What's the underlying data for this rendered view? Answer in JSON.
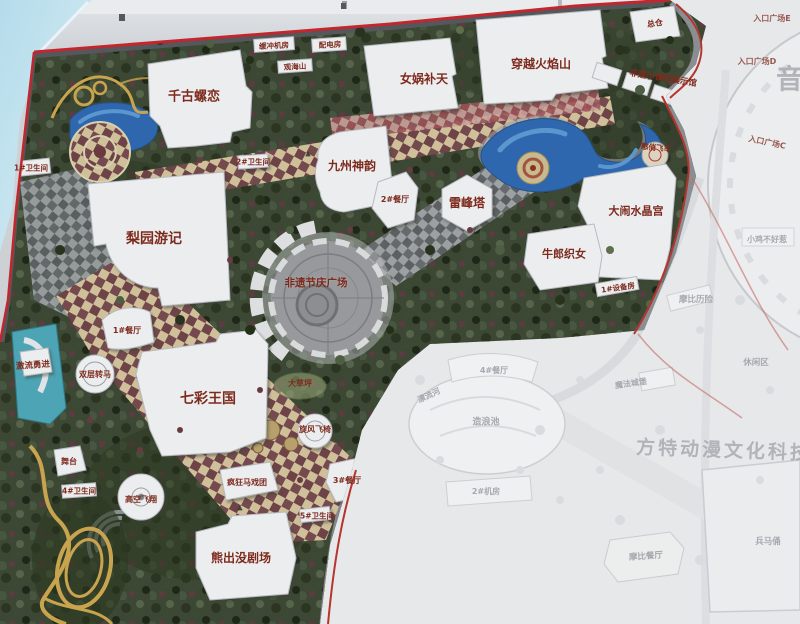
{
  "meta": {
    "description": "Photographed theme park master-plan map on a signboard"
  },
  "colors": {
    "label_red": "#7d2b1d",
    "faded_text": "#a2a6ab",
    "water_blue": "#2e67ad",
    "checker_maroon": "#754a4e",
    "checker_cream": "#cfc09a",
    "red_trim": "#c1272d",
    "sky_corner": "#b5dceb",
    "watermark_gray": "#a4a7ac"
  },
  "map": {
    "labels": [
      {
        "t": "千古螺恋",
        "x": 194,
        "y": 97,
        "s": 13,
        "c": "park"
      },
      {
        "t": "女娲补天",
        "x": 424,
        "y": 79,
        "s": 12,
        "c": "park"
      },
      {
        "t": "穿越火焰山",
        "x": 541,
        "y": 64,
        "s": 12,
        "c": "park"
      },
      {
        "t": "九州神韵",
        "x": 352,
        "y": 166,
        "s": 12,
        "c": "park"
      },
      {
        "t": "雷峰塔",
        "x": 467,
        "y": 203,
        "s": 12,
        "c": "park"
      },
      {
        "t": "大闹水晶宫",
        "x": 636,
        "y": 211,
        "s": 11,
        "c": "park"
      },
      {
        "t": "牛郎织女",
        "x": 564,
        "y": 254,
        "s": 11,
        "c": "park"
      },
      {
        "t": "梨园游记",
        "x": 154,
        "y": 239,
        "s": 14,
        "c": "park"
      },
      {
        "t": "七彩王国",
        "x": 208,
        "y": 399,
        "s": 14,
        "c": "park"
      },
      {
        "t": "熊出没剧场",
        "x": 241,
        "y": 558,
        "s": 12,
        "c": "park"
      },
      {
        "t": "非遗节庆广场",
        "x": 316,
        "y": 283,
        "s": 10.5,
        "c": "park"
      },
      {
        "t": "总仓",
        "x": 655,
        "y": 24,
        "s": 8,
        "c": "park-sm",
        "r": -8
      },
      {
        "t": "2#餐厅",
        "x": 395,
        "y": 200,
        "s": 8,
        "c": "park-sm"
      },
      {
        "t": "1#餐厅",
        "x": 127,
        "y": 331,
        "s": 8,
        "c": "park-sm"
      },
      {
        "t": "双层转马",
        "x": 95,
        "y": 375,
        "s": 8,
        "c": "park-sm"
      },
      {
        "t": "激流勇进",
        "x": 33,
        "y": 366,
        "s": 8.5,
        "c": "park-sm",
        "r": -4
      },
      {
        "t": "舞台",
        "x": 69,
        "y": 462,
        "s": 8,
        "c": "park-sm"
      },
      {
        "t": "高空飞翔",
        "x": 141,
        "y": 500,
        "s": 8,
        "c": "park-sm"
      },
      {
        "t": "4#卫生间",
        "x": 79,
        "y": 491,
        "s": 7.5,
        "c": "park-sm"
      },
      {
        "t": "疯狂马戏团",
        "x": 247,
        "y": 483,
        "s": 8,
        "c": "park-sm"
      },
      {
        "t": "旋风飞椅",
        "x": 315,
        "y": 430,
        "s": 8,
        "c": "park-sm"
      },
      {
        "t": "3#餐厅",
        "x": 347,
        "y": 481,
        "s": 8,
        "c": "park-sm"
      },
      {
        "t": "5#卫生间",
        "x": 317,
        "y": 516,
        "s": 7.5,
        "c": "park-sm"
      },
      {
        "t": "1#卫生间",
        "x": 31,
        "y": 168,
        "s": 7.5,
        "c": "park-sm"
      },
      {
        "t": "2#卫生间",
        "x": 253,
        "y": 162,
        "s": 7.5,
        "c": "park-sm"
      },
      {
        "t": "1#设备房",
        "x": 618,
        "y": 288,
        "s": 7.5,
        "c": "park-sm",
        "r": -8
      },
      {
        "t": "缓冲机房",
        "x": 274,
        "y": 46,
        "s": 7.5,
        "c": "park-sm",
        "r": -3
      },
      {
        "t": "配电房",
        "x": 330,
        "y": 45,
        "s": 7.5,
        "c": "park-sm",
        "r": -3
      },
      {
        "t": "观海山",
        "x": 295,
        "y": 67,
        "s": 7.5,
        "c": "park-sm",
        "r": -3
      },
      {
        "t": "憨俏飞车",
        "x": 656,
        "y": 148,
        "s": 7.5,
        "c": "park-sm",
        "r": 6
      },
      {
        "t": "大草坪",
        "x": 300,
        "y": 384,
        "s": 8,
        "c": "park-sm"
      },
      {
        "t": "非遗小镇和展示馆",
        "x": 663,
        "y": 79,
        "s": 8.5,
        "c": "park-sm",
        "r": 9
      },
      {
        "t": "入口广场E",
        "x": 772,
        "y": 19,
        "s": 8,
        "c": "entrance"
      },
      {
        "t": "入口广场D",
        "x": 757,
        "y": 62,
        "s": 8,
        "c": "entrance"
      },
      {
        "t": "入口广场C",
        "x": 767,
        "y": 143,
        "s": 8,
        "c": "entrance",
        "r": 12
      },
      {
        "t": "4#餐厅",
        "x": 494,
        "y": 371,
        "s": 8,
        "c": "faded"
      },
      {
        "t": "漂流河",
        "x": 429,
        "y": 396,
        "s": 8,
        "c": "faded",
        "r": -25
      },
      {
        "t": "造浪池",
        "x": 486,
        "y": 423,
        "s": 9,
        "c": "faded"
      },
      {
        "t": "2#机房",
        "x": 486,
        "y": 492,
        "s": 8,
        "c": "faded"
      },
      {
        "t": "小鸡不好惹",
        "x": 767,
        "y": 240,
        "s": 8,
        "c": "faded"
      },
      {
        "t": "摩比历险",
        "x": 696,
        "y": 300,
        "s": 8.5,
        "c": "faded"
      },
      {
        "t": "休闲区",
        "x": 756,
        "y": 363,
        "s": 8.5,
        "c": "faded"
      },
      {
        "t": "魔法城堡",
        "x": 631,
        "y": 384,
        "s": 8,
        "c": "faded",
        "r": -8
      },
      {
        "t": "摩比餐厅",
        "x": 646,
        "y": 557,
        "s": 8.5,
        "c": "faded",
        "r": -4
      },
      {
        "t": "兵马俑",
        "x": 768,
        "y": 542,
        "s": 8.5,
        "c": "faded"
      },
      {
        "t": "方特动漫文化科技",
        "x": 724,
        "y": 451,
        "s": 19,
        "c": "watermark",
        "r": 2
      },
      {
        "t": "音",
        "x": 791,
        "y": 80,
        "s": 27,
        "c": "watermark"
      },
      {
        "t": "▲",
        "x": 308,
        "y": 154,
        "s": 7,
        "c": "marker"
      },
      {
        "t": "▲",
        "x": 240,
        "y": 508,
        "s": 7,
        "c": "marker"
      }
    ]
  }
}
